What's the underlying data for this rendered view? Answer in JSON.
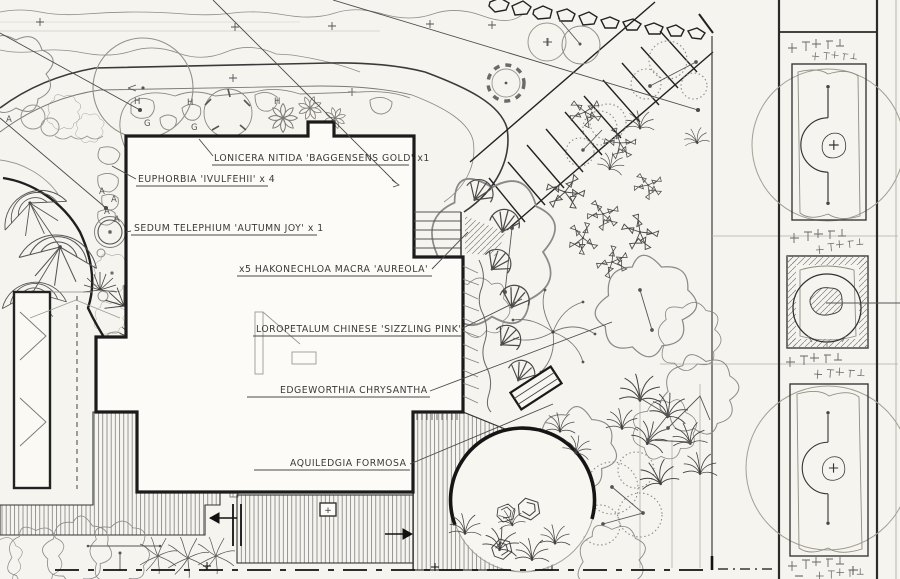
{
  "drawing_title": "Residential landscape planting plan",
  "plant_labels": {
    "lonicera": "LONICERA  NITIDA 'BAGGENSENS GOLD' x1",
    "euphorbia": "EUPHORBIA  'IVULFEHII' x 4",
    "sedum": "SEDUM  TELEPHIUM  'AUTUMN JOY' x 1",
    "hakonechloa": "x5 HAKONECHLOA  MACRA 'AUREOLA'",
    "loropetalum": "LOROPETALUM  CHINESE 'SIZZLING PINK'",
    "edgeworthia": "EDGEWORTHIA  CHRYSANTHA",
    "aquilegia": "AQUILEDGIA  FORMOSA"
  },
  "bed_letters": [
    {
      "t": "H"
    },
    {
      "t": "H"
    },
    {
      "t": "H"
    },
    {
      "t": "G"
    },
    {
      "t": "G"
    },
    {
      "t": "A"
    },
    {
      "t": "A"
    },
    {
      "t": "A"
    },
    {
      "t": "A"
    },
    {
      "t": "A"
    }
  ],
  "markers": {
    "deck_plus": "+"
  },
  "colors": {
    "paper": "#f6f4ef",
    "ink": "#1f1f1f",
    "pencil": "#8b8b8b"
  }
}
